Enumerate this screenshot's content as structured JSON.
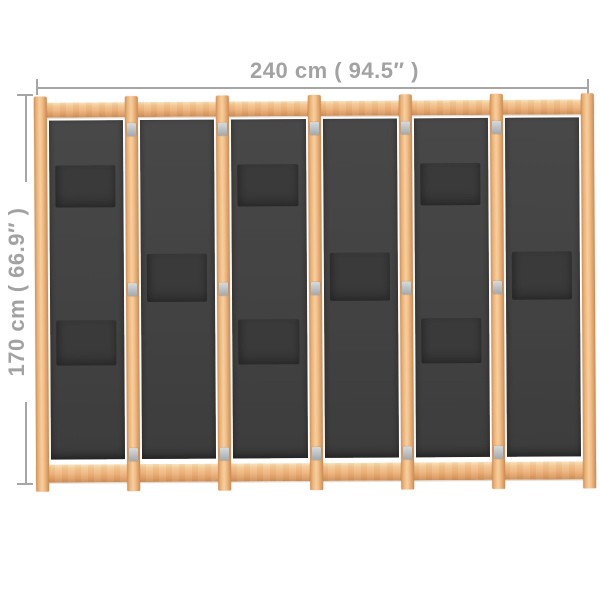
{
  "dimensions": {
    "width": {
      "label": "240 cm ( 94.5″ )"
    },
    "height": {
      "label": "170 cm ( 66.9″ )"
    }
  },
  "divider": {
    "panel_count": 6,
    "stile_count": 7,
    "hinge_rows_per_joint": 3,
    "panels": [
      {
        "id": 1,
        "pockets": [
          "upper",
          "lower"
        ]
      },
      {
        "id": 2,
        "pockets": [
          "middle"
        ]
      },
      {
        "id": 3,
        "pockets": [
          "upper",
          "lower"
        ]
      },
      {
        "id": 4,
        "pockets": [
          "middle"
        ]
      },
      {
        "id": 5,
        "pockets": [
          "upper",
          "lower"
        ]
      },
      {
        "id": 6,
        "pockets": [
          "middle"
        ]
      }
    ]
  },
  "colors": {
    "wood_mid": "#f0bd8a",
    "wood_highlight": "#f8dcb4",
    "wood_shadow": "#cc8f58",
    "fabric": "#434343",
    "pocket": "#3a3a3a",
    "hinge": "#bfc4c8",
    "dimension_line": "#a6a6a6",
    "dimension_text": "#a2a2a2",
    "background": "#ffffff"
  }
}
